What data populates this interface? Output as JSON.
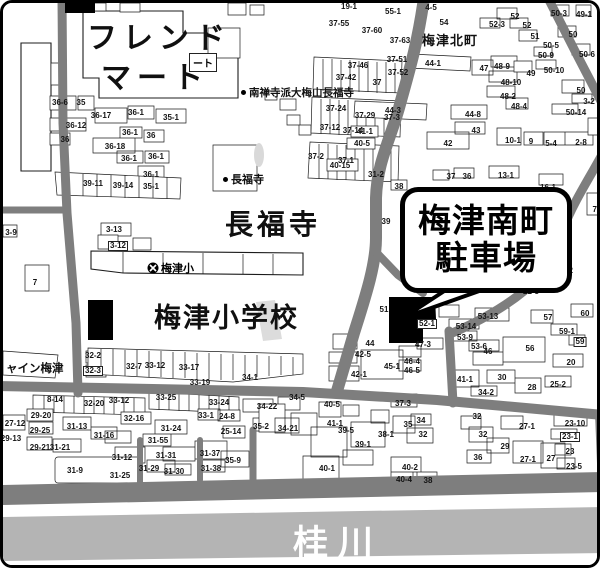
{
  "map": {
    "labels": {
      "friend_mart_1": "フレンド",
      "friend_mart_2": "マート",
      "friend_mart_tag": "ート",
      "umezu_kitamachi": "梅津北町",
      "chofukuji_big": "長福寺",
      "umezu_elementary": "梅津小学校",
      "umezu_elementary_marker": "梅津小",
      "nanzenji_poi": "南禅寺派大梅山長福寺",
      "chofukuji_poi": "長福寺",
      "shine_umezu": "ャイン梅津",
      "katsura_river": "桂川"
    },
    "callout": {
      "line1": "梅津南町",
      "line2": "駐車場"
    },
    "colors": {
      "road": "#7e7e7e",
      "river": "#b4b4b4",
      "outline": "#1c1c1c",
      "target": "#000000"
    },
    "lots": [
      {
        "t": "36-6",
        "x": 57,
        "y": 100
      },
      {
        "t": "35",
        "x": 78,
        "y": 100
      },
      {
        "t": "36-17",
        "x": 98,
        "y": 113
      },
      {
        "t": "36-1",
        "x": 133,
        "y": 110
      },
      {
        "t": "35-1",
        "x": 168,
        "y": 115
      },
      {
        "t": "36-12",
        "x": 73,
        "y": 123
      },
      {
        "t": "36",
        "x": 62,
        "y": 137
      },
      {
        "t": "36-1",
        "x": 127,
        "y": 130
      },
      {
        "t": "36",
        "x": 148,
        "y": 133
      },
      {
        "t": "36-18",
        "x": 112,
        "y": 144
      },
      {
        "t": "36-1",
        "x": 126,
        "y": 156
      },
      {
        "t": "36-1",
        "x": 153,
        "y": 154
      },
      {
        "t": "36-1",
        "x": 148,
        "y": 172
      },
      {
        "t": "39-11",
        "x": 90,
        "y": 181
      },
      {
        "t": "39-14",
        "x": 120,
        "y": 183
      },
      {
        "t": "35-1",
        "x": 148,
        "y": 184
      },
      {
        "t": "19-1",
        "x": 346,
        "y": 4
      },
      {
        "t": "55-1",
        "x": 390,
        "y": 9
      },
      {
        "t": "37-55",
        "x": 336,
        "y": 21
      },
      {
        "t": "37-60",
        "x": 369,
        "y": 28
      },
      {
        "t": "37-63",
        "x": 397,
        "y": 38
      },
      {
        "t": "4-5",
        "x": 428,
        "y": 5
      },
      {
        "t": "54",
        "x": 441,
        "y": 20
      },
      {
        "t": "37-51",
        "x": 394,
        "y": 57
      },
      {
        "t": "37-46",
        "x": 355,
        "y": 63
      },
      {
        "t": "37-52",
        "x": 395,
        "y": 70
      },
      {
        "t": "37-42",
        "x": 343,
        "y": 75
      },
      {
        "t": "37",
        "x": 374,
        "y": 80
      },
      {
        "t": "37-24",
        "x": 333,
        "y": 106
      },
      {
        "t": "37-29",
        "x": 362,
        "y": 113
      },
      {
        "t": "37-3",
        "x": 389,
        "y": 115
      },
      {
        "t": "37-12",
        "x": 327,
        "y": 125
      },
      {
        "t": "37-14",
        "x": 350,
        "y": 128
      },
      {
        "t": "37-2",
        "x": 313,
        "y": 154
      },
      {
        "t": "37-1",
        "x": 343,
        "y": 158
      },
      {
        "t": "31-2",
        "x": 373,
        "y": 172
      },
      {
        "t": "38",
        "x": 396,
        "y": 184
      },
      {
        "t": "39",
        "x": 383,
        "y": 219
      },
      {
        "t": "44-1",
        "x": 430,
        "y": 61
      },
      {
        "t": "47",
        "x": 481,
        "y": 66
      },
      {
        "t": "48-9",
        "x": 499,
        "y": 64
      },
      {
        "t": "48-10",
        "x": 508,
        "y": 80
      },
      {
        "t": "48-2",
        "x": 505,
        "y": 94
      },
      {
        "t": "44-3",
        "x": 390,
        "y": 108
      },
      {
        "t": "44-8",
        "x": 470,
        "y": 112
      },
      {
        "t": "48-4",
        "x": 516,
        "y": 104
      },
      {
        "t": "43",
        "x": 473,
        "y": 128
      },
      {
        "t": "42",
        "x": 445,
        "y": 141
      },
      {
        "t": "10-1",
        "x": 510,
        "y": 138
      },
      {
        "t": "9",
        "x": 528,
        "y": 139
      },
      {
        "t": "5-4",
        "x": 548,
        "y": 141
      },
      {
        "t": "2-8",
        "x": 578,
        "y": 140
      },
      {
        "t": "41-1",
        "x": 362,
        "y": 129
      },
      {
        "t": "40-5",
        "x": 359,
        "y": 141
      },
      {
        "t": "40-15",
        "x": 337,
        "y": 163
      },
      {
        "t": "37",
        "x": 448,
        "y": 174
      },
      {
        "t": "36",
        "x": 464,
        "y": 174
      },
      {
        "t": "13-1",
        "x": 503,
        "y": 173
      },
      {
        "t": "16-1",
        "x": 545,
        "y": 185
      },
      {
        "t": "72",
        "x": 594,
        "y": 207
      },
      {
        "t": "19-4",
        "x": 560,
        "y": 251
      },
      {
        "t": "19-2",
        "x": 562,
        "y": 268
      },
      {
        "t": "22-5",
        "x": 528,
        "y": 289
      },
      {
        "t": "52",
        "x": 512,
        "y": 14
      },
      {
        "t": "52-3",
        "x": 494,
        "y": 22
      },
      {
        "t": "52",
        "x": 524,
        "y": 23
      },
      {
        "t": "51",
        "x": 532,
        "y": 34
      },
      {
        "t": "50-3",
        "x": 556,
        "y": 11
      },
      {
        "t": "49-1",
        "x": 581,
        "y": 12
      },
      {
        "t": "50",
        "x": 570,
        "y": 32
      },
      {
        "t": "50-5",
        "x": 548,
        "y": 43
      },
      {
        "t": "50-9",
        "x": 543,
        "y": 53
      },
      {
        "t": "50-6",
        "x": 584,
        "y": 52
      },
      {
        "t": "50-10",
        "x": 551,
        "y": 68
      },
      {
        "t": "49",
        "x": 528,
        "y": 71
      },
      {
        "t": "50",
        "x": 578,
        "y": 88
      },
      {
        "t": "3-2",
        "x": 586,
        "y": 99
      },
      {
        "t": "50-14",
        "x": 573,
        "y": 110
      },
      {
        "t": "51",
        "x": 381,
        "y": 307
      },
      {
        "t": "52-1",
        "x": 424,
        "y": 321,
        "b": 1
      },
      {
        "t": "44",
        "x": 367,
        "y": 341
      },
      {
        "t": "42-5",
        "x": 360,
        "y": 352
      },
      {
        "t": "42-1",
        "x": 356,
        "y": 372
      },
      {
        "t": "45-1",
        "x": 389,
        "y": 364
      },
      {
        "t": "46-4",
        "x": 409,
        "y": 359
      },
      {
        "t": "46-5",
        "x": 409,
        "y": 368
      },
      {
        "t": "47-3",
        "x": 420,
        "y": 342
      },
      {
        "t": "37-3",
        "x": 400,
        "y": 401
      },
      {
        "t": "53-13",
        "x": 485,
        "y": 314
      },
      {
        "t": "53-14",
        "x": 463,
        "y": 324
      },
      {
        "t": "53-9",
        "x": 462,
        "y": 335
      },
      {
        "t": "53-6",
        "x": 476,
        "y": 344
      },
      {
        "t": "57",
        "x": 545,
        "y": 315
      },
      {
        "t": "60",
        "x": 582,
        "y": 311
      },
      {
        "t": "59-1",
        "x": 564,
        "y": 329
      },
      {
        "t": "59",
        "x": 577,
        "y": 339,
        "b": 1
      },
      {
        "t": "56",
        "x": 527,
        "y": 346
      },
      {
        "t": "46",
        "x": 485,
        "y": 349
      },
      {
        "t": "20",
        "x": 568,
        "y": 360
      },
      {
        "t": "41-1",
        "x": 462,
        "y": 377
      },
      {
        "t": "30",
        "x": 499,
        "y": 375
      },
      {
        "t": "28",
        "x": 529,
        "y": 385
      },
      {
        "t": "25-2",
        "x": 555,
        "y": 382
      },
      {
        "t": "34-2",
        "x": 483,
        "y": 390
      },
      {
        "t": "32",
        "x": 474,
        "y": 414
      },
      {
        "t": "32",
        "x": 480,
        "y": 432
      },
      {
        "t": "27-1",
        "x": 524,
        "y": 424
      },
      {
        "t": "23-10",
        "x": 572,
        "y": 421
      },
      {
        "t": "23-1",
        "x": 567,
        "y": 434,
        "b": 1
      },
      {
        "t": "29",
        "x": 502,
        "y": 444
      },
      {
        "t": "36",
        "x": 475,
        "y": 455
      },
      {
        "t": "27-1",
        "x": 525,
        "y": 457
      },
      {
        "t": "27",
        "x": 548,
        "y": 456
      },
      {
        "t": "23",
        "x": 567,
        "y": 449
      },
      {
        "t": "23-5",
        "x": 571,
        "y": 464
      },
      {
        "t": "27-12",
        "x": 12,
        "y": 421
      },
      {
        "t": "29-20",
        "x": 38,
        "y": 413
      },
      {
        "t": "29-25",
        "x": 37,
        "y": 428
      },
      {
        "t": "29-13",
        "x": 8,
        "y": 436
      },
      {
        "t": "31-13",
        "x": 74,
        "y": 424
      },
      {
        "t": "31-16",
        "x": 101,
        "y": 433
      },
      {
        "t": "29-21",
        "x": 37,
        "y": 445
      },
      {
        "t": "31-21",
        "x": 57,
        "y": 445
      },
      {
        "t": "32-16",
        "x": 131,
        "y": 416
      },
      {
        "t": "31-24",
        "x": 168,
        "y": 426
      },
      {
        "t": "31-55",
        "x": 155,
        "y": 438
      },
      {
        "t": "31-12",
        "x": 119,
        "y": 455
      },
      {
        "t": "31-31",
        "x": 163,
        "y": 453
      },
      {
        "t": "31-37",
        "x": 207,
        "y": 451
      },
      {
        "t": "35-9",
        "x": 230,
        "y": 458
      },
      {
        "t": "31-9",
        "x": 72,
        "y": 468
      },
      {
        "t": "31-25",
        "x": 117,
        "y": 473
      },
      {
        "t": "31-29",
        "x": 146,
        "y": 466
      },
      {
        "t": "31-30",
        "x": 171,
        "y": 469
      },
      {
        "t": "31-38",
        "x": 208,
        "y": 466
      },
      {
        "t": "8-14",
        "x": 52,
        "y": 397
      },
      {
        "t": "32-20",
        "x": 91,
        "y": 401
      },
      {
        "t": "33-12",
        "x": 116,
        "y": 398
      },
      {
        "t": "33-25",
        "x": 163,
        "y": 395
      },
      {
        "t": "33-24",
        "x": 216,
        "y": 400
      },
      {
        "t": "33-1",
        "x": 203,
        "y": 413
      },
      {
        "t": "24-8",
        "x": 224,
        "y": 414
      },
      {
        "t": "25-14",
        "x": 228,
        "y": 429
      },
      {
        "t": "34-22",
        "x": 264,
        "y": 404
      },
      {
        "t": "34-5",
        "x": 294,
        "y": 395
      },
      {
        "t": "35-2",
        "x": 258,
        "y": 424
      },
      {
        "t": "34-21",
        "x": 285,
        "y": 426
      },
      {
        "t": "32-2",
        "x": 90,
        "y": 353
      },
      {
        "t": "32-3",
        "x": 90,
        "y": 368,
        "b": 1
      },
      {
        "t": "32-7",
        "x": 131,
        "y": 364
      },
      {
        "t": "33-12",
        "x": 152,
        "y": 363
      },
      {
        "t": "33-17",
        "x": 186,
        "y": 365
      },
      {
        "t": "33-19",
        "x": 197,
        "y": 380
      },
      {
        "t": "34-1",
        "x": 247,
        "y": 375
      },
      {
        "t": "3-13",
        "x": 111,
        "y": 227
      },
      {
        "t": "3-12",
        "x": 115,
        "y": 243,
        "b": 1
      },
      {
        "t": "3-9",
        "x": 8,
        "y": 230
      },
      {
        "t": "7",
        "x": 32,
        "y": 280
      },
      {
        "t": "40-5",
        "x": 329,
        "y": 402
      },
      {
        "t": "41-1",
        "x": 332,
        "y": 421
      },
      {
        "t": "39-5",
        "x": 343,
        "y": 428
      },
      {
        "t": "39-1",
        "x": 360,
        "y": 442
      },
      {
        "t": "38-1",
        "x": 383,
        "y": 432
      },
      {
        "t": "35",
        "x": 405,
        "y": 422
      },
      {
        "t": "34",
        "x": 418,
        "y": 418
      },
      {
        "t": "32",
        "x": 420,
        "y": 432
      },
      {
        "t": "40-1",
        "x": 324,
        "y": 466
      },
      {
        "t": "40-2",
        "x": 407,
        "y": 465
      },
      {
        "t": "40-4",
        "x": 401,
        "y": 477
      },
      {
        "t": "38",
        "x": 425,
        "y": 478
      }
    ]
  }
}
